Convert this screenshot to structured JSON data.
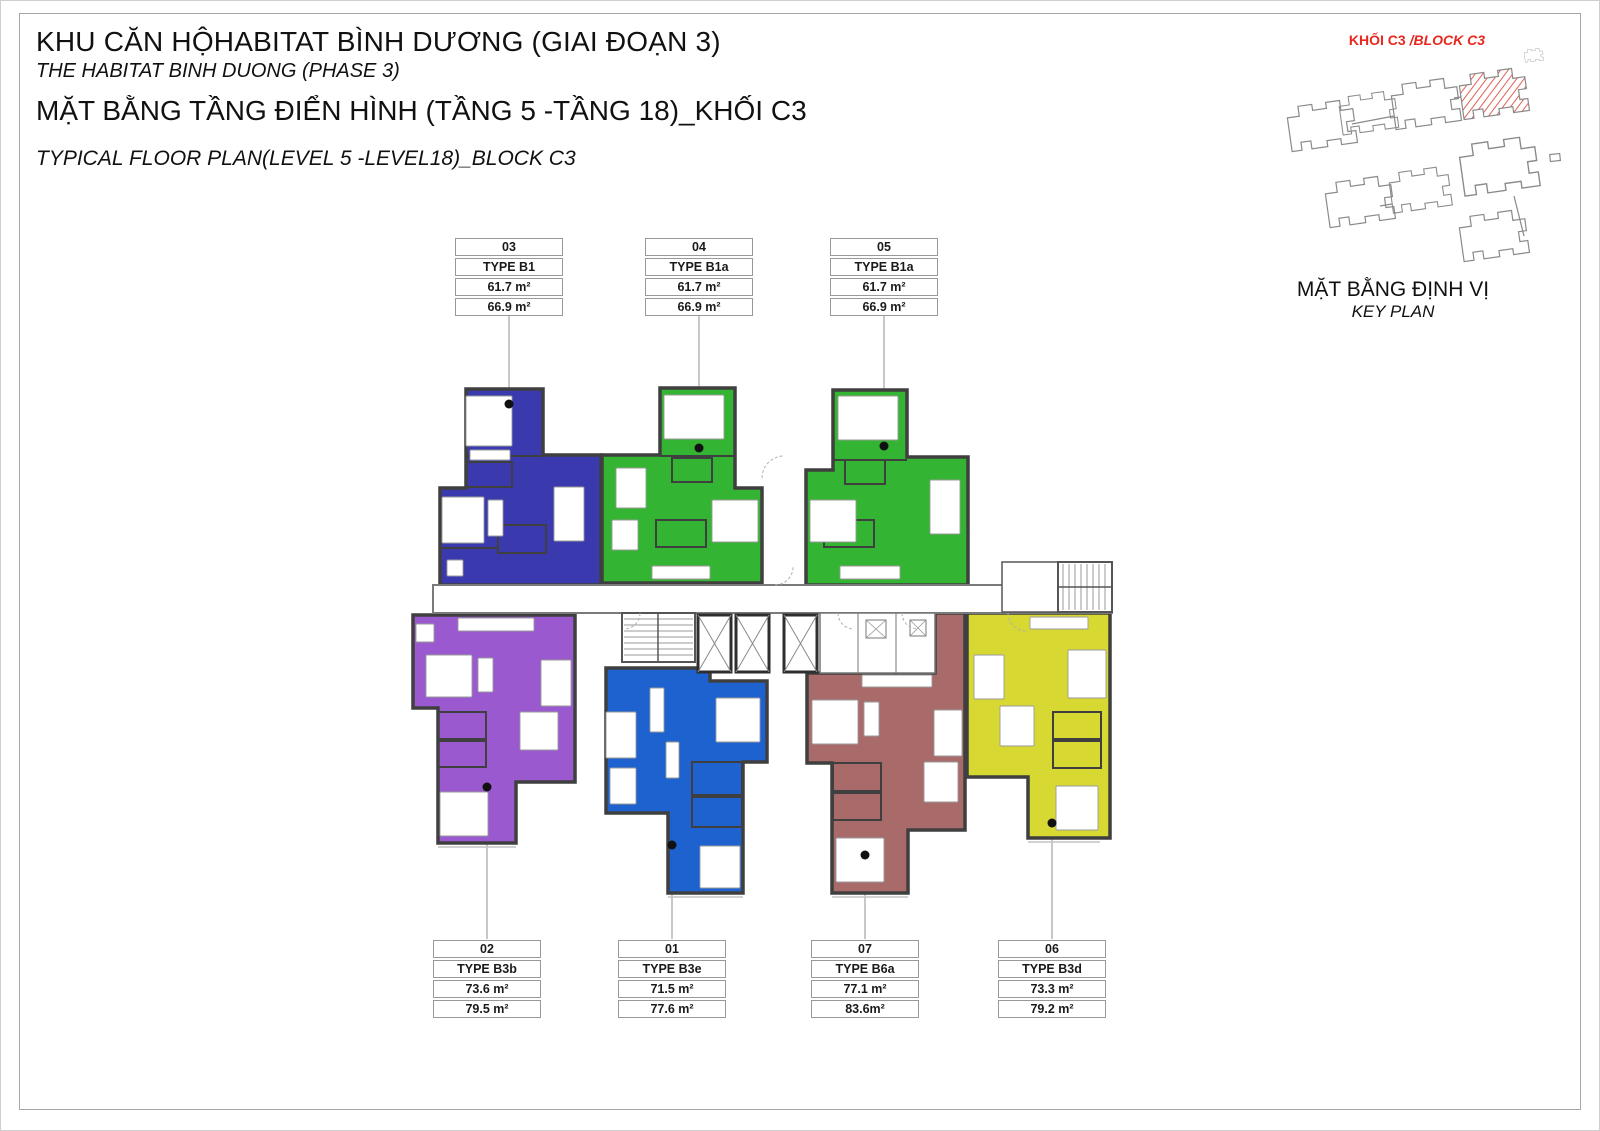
{
  "page": {
    "title_vi": "KHU CĂN HỘHABITAT BÌNH DƯƠNG (GIAI ĐOẠN 3)",
    "title_en": "THE HABITAT BINH DUONG (PHASE 3)",
    "subtitle_vi": "MẶT BẰNG TẦNG ĐIỂN HÌNH (TẦNG 5 -TẦNG 18)_KHỐI C3",
    "subtitle_en": "TYPICAL FLOOR PLAN(LEVEL 5 -LEVEL18)_BLOCK C3"
  },
  "key_plan": {
    "block_label_vi": "KHỐI C3 ",
    "block_label_en": "/BLOCK C3",
    "caption_vi": "MẶT BẰNG ĐỊNH VỊ",
    "caption_en": "KEY PLAN",
    "highlight_color": "#e8281e"
  },
  "units": [
    {
      "number": "03",
      "type": "TYPE B1",
      "area_net": "61.7 m²",
      "area_gross": "66.9 m²",
      "color": "#3a3aae"
    },
    {
      "number": "04",
      "type": "TYPE B1a",
      "area_net": "61.7 m²",
      "area_gross": "66.9 m²",
      "color": "#33b433"
    },
    {
      "number": "05",
      "type": "TYPE B1a",
      "area_net": "61.7 m²",
      "area_gross": "66.9 m²",
      "color": "#33b433"
    },
    {
      "number": "02",
      "type": "TYPE B3b",
      "area_net": "73.6 m²",
      "area_gross": "79.5 m²",
      "color": "#9b59d0"
    },
    {
      "number": "01",
      "type": "TYPE B3e",
      "area_net": "71.5 m²",
      "area_gross": "77.6 m²",
      "color": "#1e62d0"
    },
    {
      "number": "07",
      "type": "TYPE B6a",
      "area_net": "77.1 m²",
      "area_gross": "83.6m²",
      "color": "#a96a6a"
    },
    {
      "number": "06",
      "type": "TYPE B3d",
      "area_net": "73.3 m²",
      "area_gross": "79.2 m²",
      "color": "#d8d832"
    }
  ]
}
